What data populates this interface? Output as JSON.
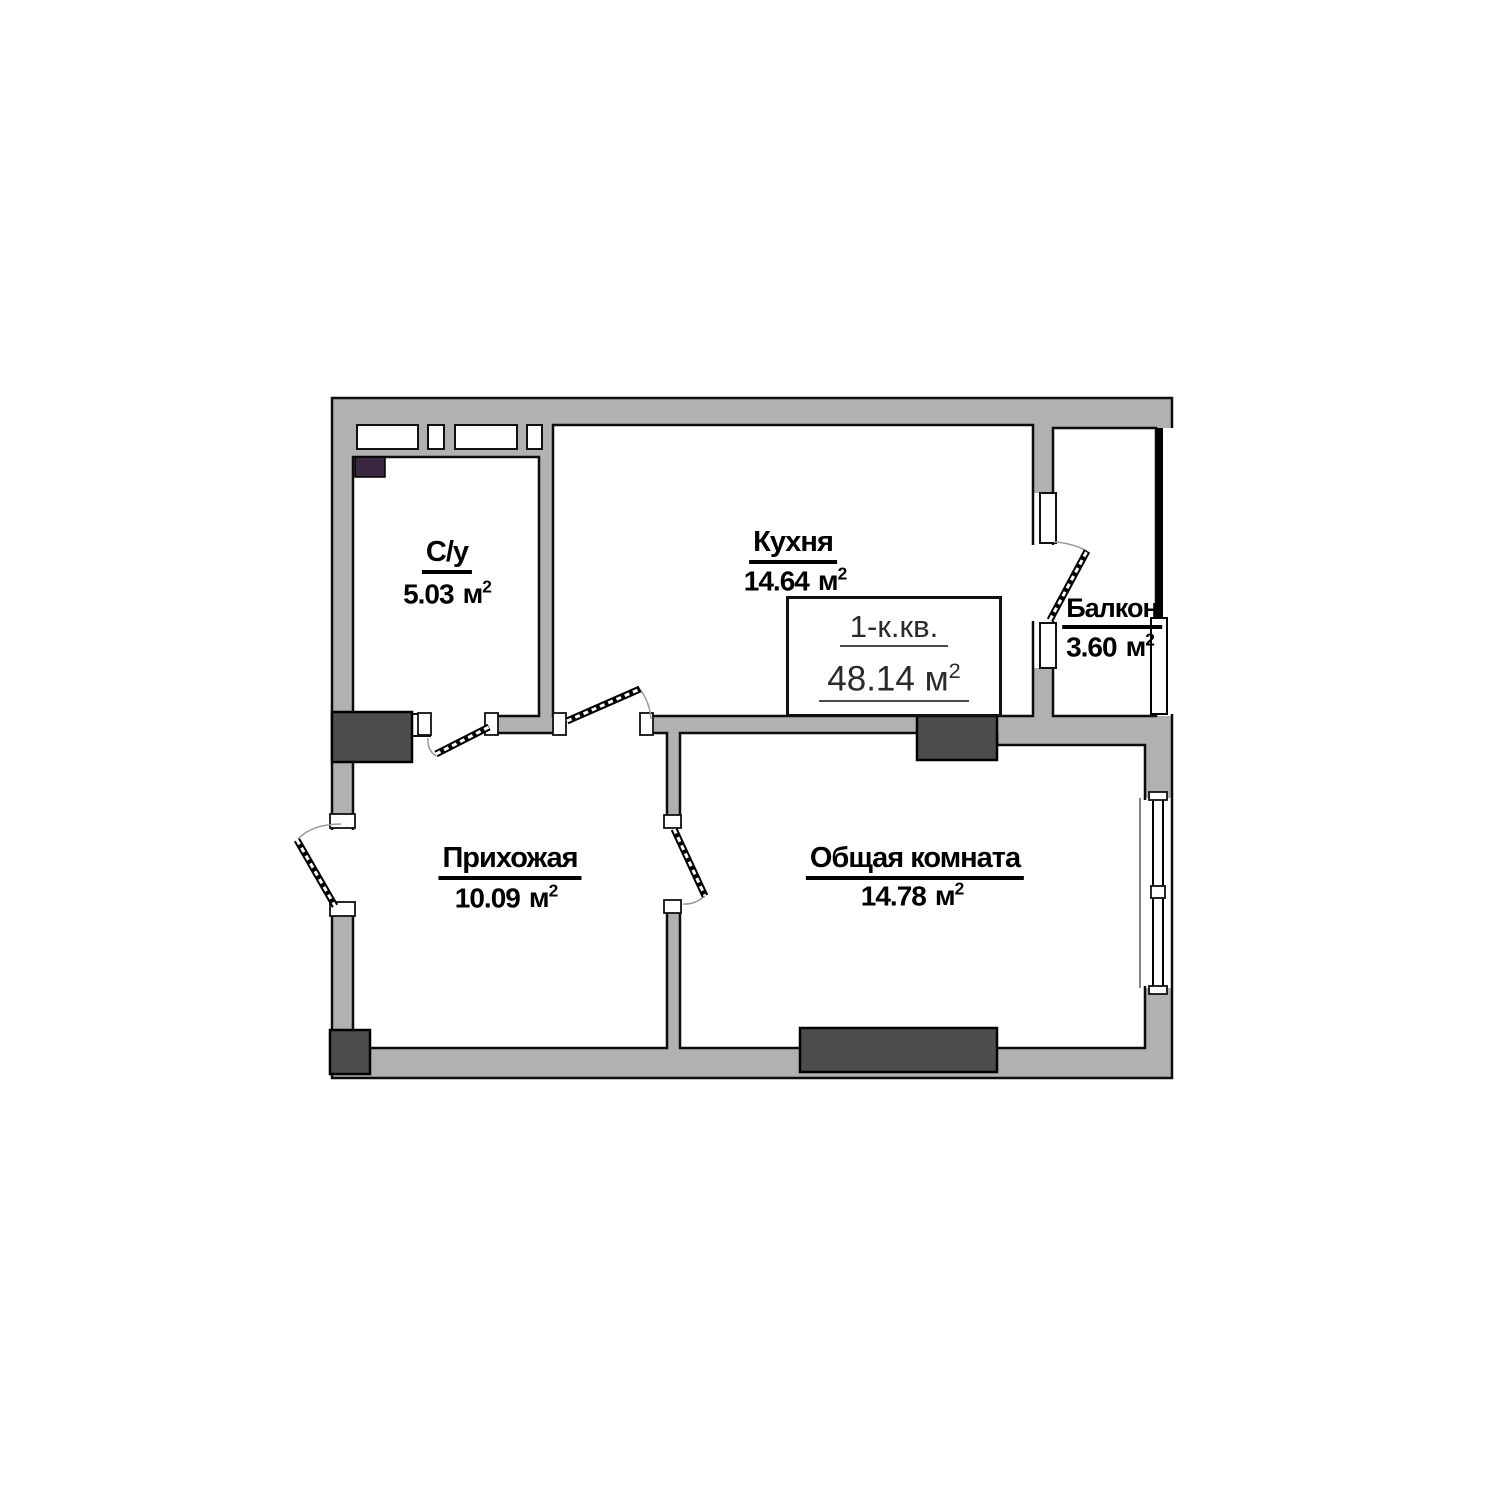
{
  "plan": {
    "colors": {
      "wall": "#b1b1b1",
      "dark": "#4d4d4d",
      "accent": "#3a2740",
      "line": "#0d0d0d"
    },
    "title_box": {
      "apartment_type": "1-к.кв.",
      "total_area": "48.14",
      "unit": "м",
      "sup": "2"
    },
    "rooms": [
      {
        "key": "bathroom",
        "name": "С/у",
        "area": "5.03",
        "unit": "м",
        "sup": "2"
      },
      {
        "key": "kitchen",
        "name": "Кухня",
        "area": "14.64",
        "unit": "м",
        "sup": "2"
      },
      {
        "key": "balcony",
        "name": "Балкон",
        "area": "3.60",
        "unit": "м",
        "sup": "2"
      },
      {
        "key": "hallway",
        "name": "Прихожая",
        "area": "10.09",
        "unit": "м",
        "sup": "2"
      },
      {
        "key": "living_room",
        "name": "Общая комната",
        "area": "14.78",
        "unit": "м",
        "sup": "2"
      }
    ]
  }
}
